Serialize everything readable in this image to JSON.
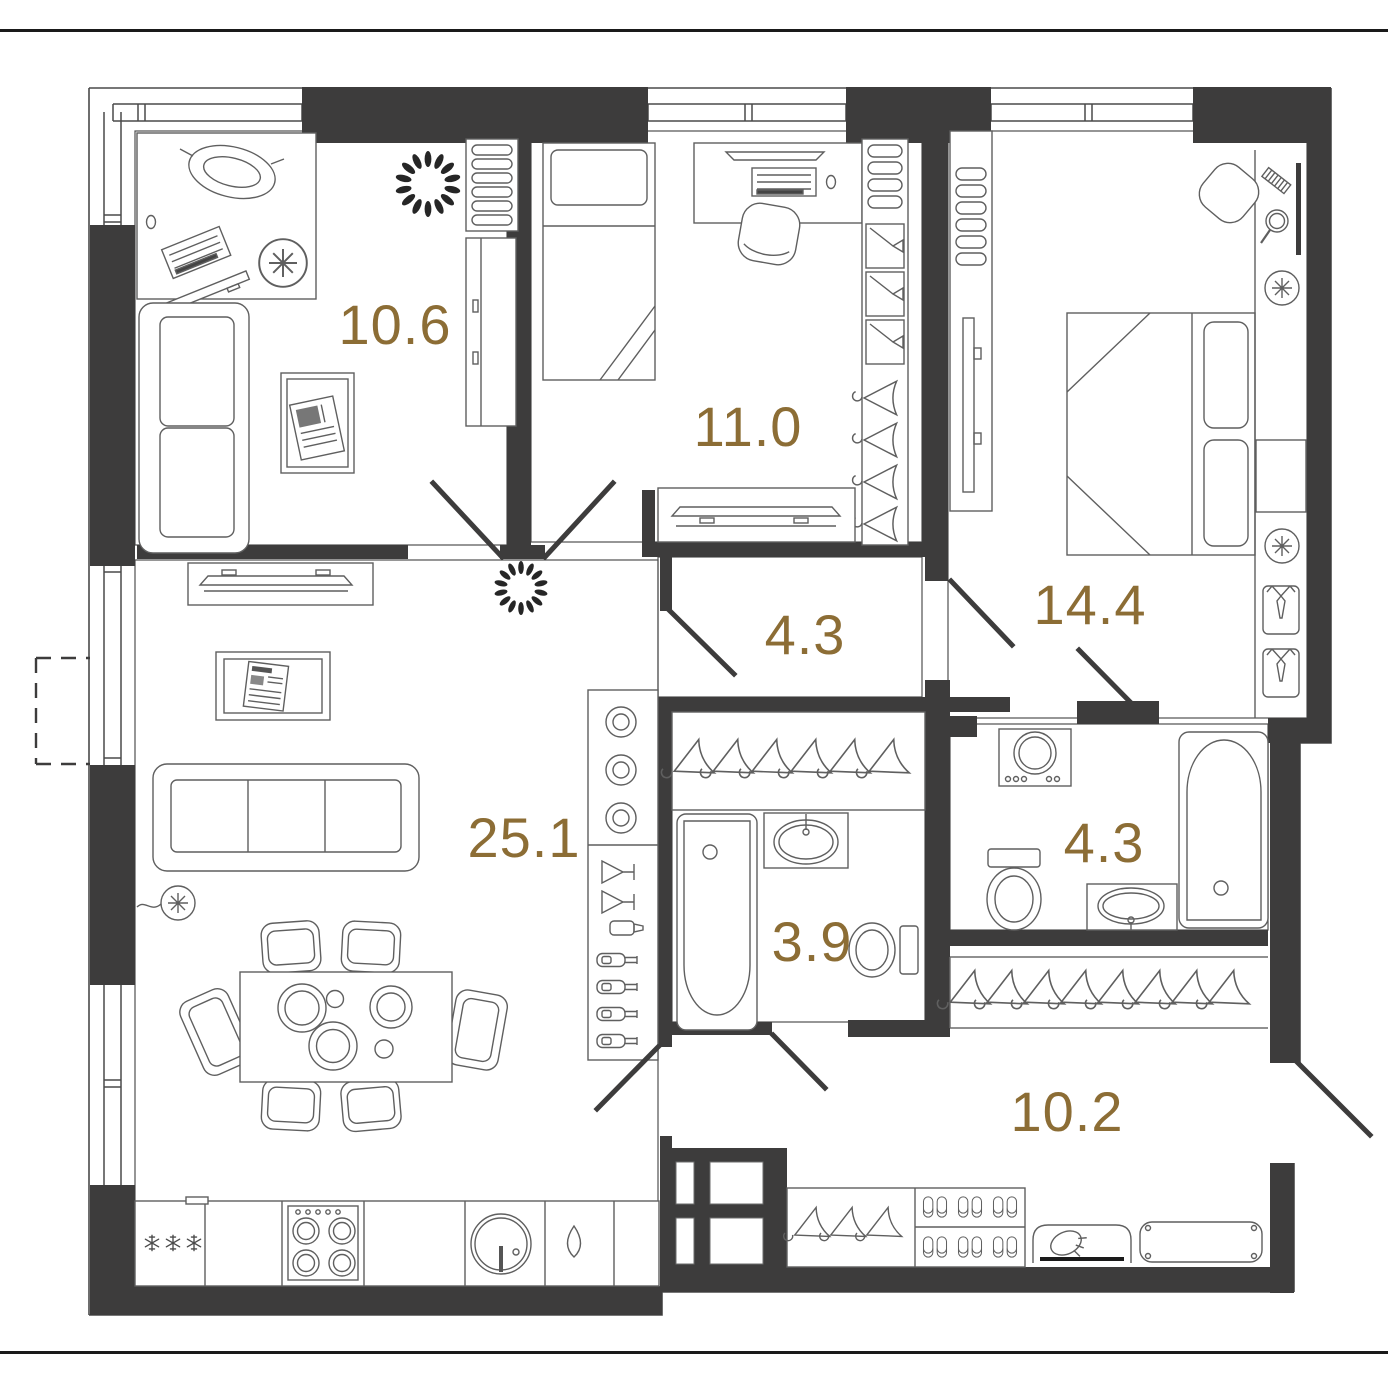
{
  "document": {
    "kind": "apartment-floor-plan",
    "units": "m2"
  },
  "colors": {
    "background": "#ffffff",
    "wall": "#3d3c3c",
    "furniture_line": "#5f5f5f",
    "thin_line": "#4a4a4a",
    "label": "#8c6d35",
    "frame_line": "#1a1a1a"
  },
  "rooms": [
    {
      "id": "room-10-6",
      "area": "10.6"
    },
    {
      "id": "room-11-0",
      "area": "11.0"
    },
    {
      "id": "room-14-4",
      "area": "14.4"
    },
    {
      "id": "hall-4-3",
      "area": "4.3"
    },
    {
      "id": "living-25-1",
      "area": "25.1"
    },
    {
      "id": "bath-3-9",
      "area": "3.9"
    },
    {
      "id": "bath-4-3",
      "area": "4.3"
    },
    {
      "id": "hall-10-2",
      "area": "10.2"
    }
  ],
  "icons": [
    "window-icon",
    "balcony-dashed-icon",
    "door-leaf-icon",
    "entrance-door-icon",
    "desk-icon",
    "office-chair-icon",
    "keyboard-icon",
    "monitor-icon",
    "sofa-icon",
    "coffee-table-icon",
    "plant-icon",
    "shelf-icon",
    "cabinet-icon",
    "tv-console-icon",
    "bed-icon",
    "pillow-icon",
    "wardrobe-icon",
    "dresser-icon",
    "tv-unit-icon",
    "vanity-chair-icon",
    "comb-icon",
    "mirror-icon",
    "hand-mirror-icon",
    "wall-lamp-icon",
    "nightstand-icon",
    "shirt-box-icon",
    "hanger-rail-icon",
    "coat-hanger-icon",
    "bathtub-icon",
    "sink-icon",
    "toilet-icon",
    "washing-machine-icon",
    "bar-shelf-icon",
    "martini-glass-icon",
    "shaker-icon",
    "bottle-icon",
    "picture-frame-icon",
    "floor-lamp-icon",
    "dining-table-icon",
    "chair-icon",
    "plate-icon",
    "fridge-icon",
    "snowflake-icon",
    "stove-icon",
    "kitchen-sink-icon",
    "water-drop-icon",
    "slippers-icon",
    "shoe-brush-icon",
    "bench-icon",
    "shaft-icon"
  ]
}
